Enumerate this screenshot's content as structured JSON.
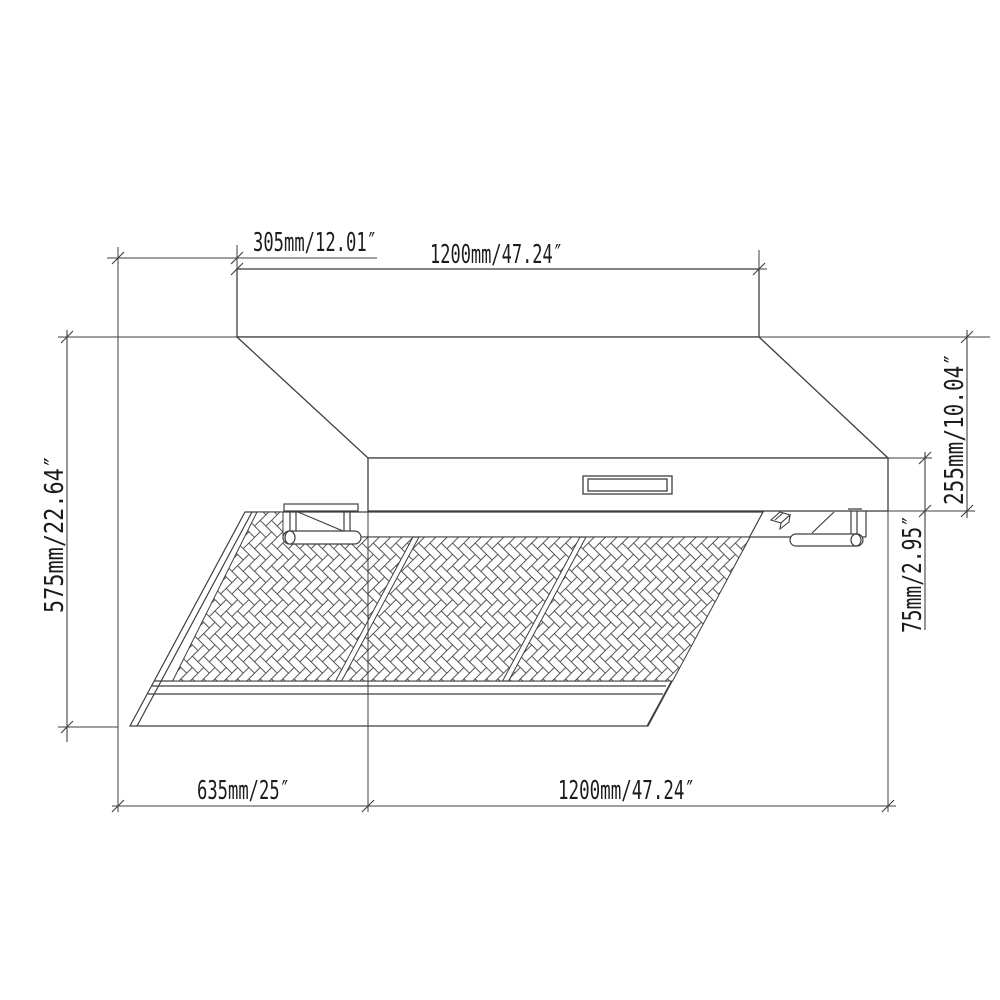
{
  "drawing": {
    "dimension_labels": {
      "top_offset": "305mm/12.01″",
      "top_width": "1200mm/47.24″",
      "left_height": "575mm/22.64″",
      "right_upper": "255mm/10.04″",
      "right_lower": "75mm/2.95″",
      "bottom_depth": "635mm/25″",
      "bottom_width": "1200mm/47.24″"
    },
    "colors": {
      "line": "#3f3f3f",
      "pattern_line": "#555555",
      "text": "#1c1c1c",
      "background": "#ffffff"
    }
  }
}
